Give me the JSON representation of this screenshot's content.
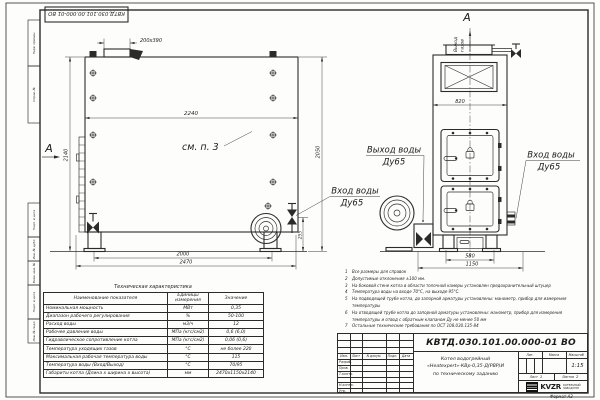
{
  "sheet": {
    "stamp_top": "КВТД.030.101.00.000-01 ВО",
    "format_note": "Формат А3"
  },
  "margin_fields": {
    "f1": "Перв. примен.",
    "f2": "Справ. №",
    "f3": "Подп. и дата",
    "f4": "Инв. № дубл.",
    "f5": "Взам. инв. №",
    "f6": "Подп. и дата",
    "f7": "Инв. № подл."
  },
  "side_view": {
    "section_label": "А",
    "detail_note": "см. п. 3",
    "dim_cutout": "200х390",
    "dim_width": "2240",
    "dim_height": "2140",
    "dim_height_right": "2050",
    "dim_feet": "2000",
    "dim_length": "2470",
    "dim_inlet_height": "255",
    "inlet_line1": "Вход воды",
    "inlet_line2": "Ду65"
  },
  "front_view": {
    "section_label": "А",
    "flue_line1": "Выход",
    "flue_line2": "газов",
    "dim_top_width": "820",
    "dim_feet": "580",
    "dim_width": "1150",
    "outlet_line1": "Выход воды",
    "outlet_line2": "Ду65",
    "inlet_line1": "Вход воды",
    "inlet_line2": "Ду65"
  },
  "notes": [
    {
      "num": "1",
      "text": "Все размеры для справок"
    },
    {
      "num": "2",
      "text": "Допустимые отклонения ±100 мм."
    },
    {
      "num": "3",
      "text": "На боковой стене котла в области топочной камеры установлен предохранительный штуцер"
    },
    {
      "num": "4",
      "text": "Температура воды на входе 70°С, на выходе 95°С."
    },
    {
      "num": "5",
      "text": "На подводящей трубе котла, до запорной арматуры установлены: манометр, прибор для измерения температуры"
    },
    {
      "num": "6",
      "text": "На отводящей трубе котла до запорной арматуры установлены: манометр, прибор для измерения температуры и отвод с обратным клапаном Ду не менее 50 мм"
    },
    {
      "num": "7",
      "text": "Остальные технические требования по ОСТ 108.030.135-84"
    }
  ],
  "spec_table": {
    "title": "Техническая характеристика",
    "col_name": "Наименование показателя",
    "col_units": "Единицы измерения",
    "col_value": "Значение",
    "rows": [
      [
        "Номинальная мощность",
        "МВт",
        "0,35"
      ],
      [
        "Диапазон рабочего регулирования",
        "%",
        "50-100"
      ],
      [
        "Расход воды",
        "м3/ч",
        "12"
      ],
      [
        "Рабочее давление воды",
        "МПа (кгс/см2)",
        "0,6 (6,0)"
      ],
      [
        "Гидравлическое сопротивление котла",
        "МПа (кгс/см2)",
        "0,06 (0,6)"
      ],
      [
        "Температура уходящих газов",
        "°С",
        "не более 220"
      ],
      [
        "Максимальная рабочая температура воды",
        "°С",
        "115"
      ],
      [
        "Температура воды (Вход/Выход)",
        "°С",
        "70/95"
      ],
      [
        "Габариты котла (Длина х ширина х высота)",
        "мм",
        "2470х1150х2140"
      ]
    ]
  },
  "title_block": {
    "doc_number": "КВТД.030.101.00.000-01 ВО",
    "product_line1": "Котел водогрейный",
    "product_line2": "«Heatexpert»-КВр-0,35-Д(РВР)И",
    "product_line3": "по техническому заданию",
    "col_izm": "Изм.",
    "col_list": "Лист",
    "col_doc": "N докум.",
    "col_podp": "Подп.",
    "col_data": "Дата",
    "row_razrab": "Разраб.",
    "row_prov": "Пров.",
    "row_tkontr": "Т.контр.",
    "row_nkontr": "Н.контр.",
    "row_utv": "Утв.",
    "lit_label": "Лит.",
    "mass_label": "Масса",
    "scale_label": "Масштаб",
    "scale_value": "1:15",
    "sheet_label": "Лист",
    "sheet_value": "1",
    "sheets_label": "Листов",
    "sheets_value": "2",
    "logo_text": "KVZR",
    "logo_cap1": "КОТЕЛЬНЫЙ",
    "logo_cap2": "ЗАВОД РЭП"
  }
}
